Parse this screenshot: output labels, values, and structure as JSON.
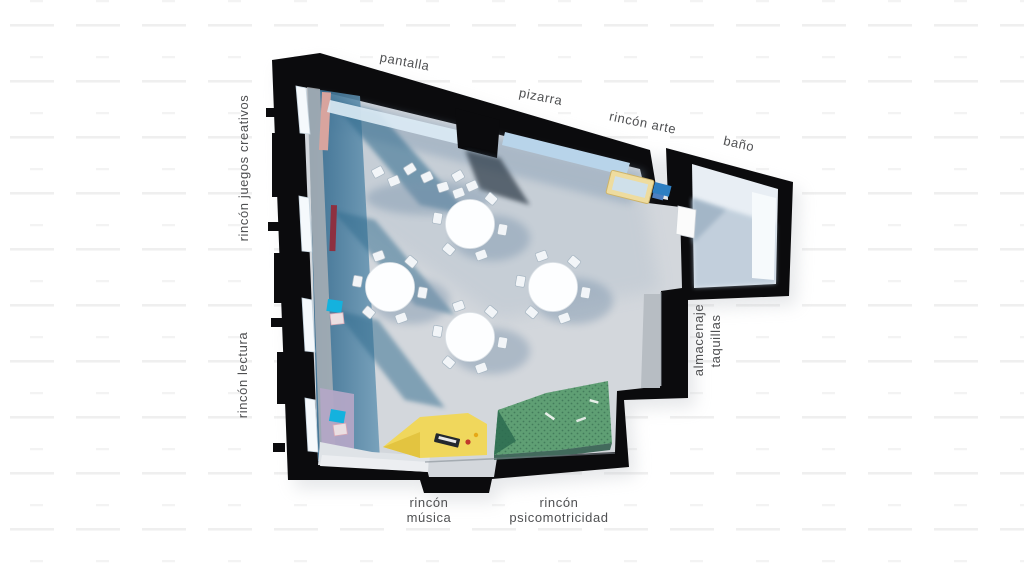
{
  "scene_type": "top-down 3D floor plan render of a classroom",
  "labels": {
    "pantalla": "pantalla",
    "pizarra": "pizarra",
    "rincon_arte": "rincón arte",
    "bano": "baño",
    "rincon_juegos_creativos": "rincón juegos creativos",
    "rincon_lectura": "rincón lectura",
    "almacenaje": {
      "line1": "almacenaje",
      "line2": "taquillas"
    },
    "rincon_musica": {
      "line1": "rincón",
      "line2": "música"
    },
    "rincon_psicomotricidad": {
      "line1": "rincón",
      "line2": "psicomotricidad"
    }
  },
  "zones": [
    {
      "label": "pantalla",
      "position": "top wall left"
    },
    {
      "label": "pizarra",
      "position": "top wall center"
    },
    {
      "label": "rincón arte",
      "position": "top wall right",
      "color": "#eedc9f"
    },
    {
      "label": "baño",
      "position": "annex room top right",
      "color": "#e8eef4"
    },
    {
      "label": "rincón juegos creativos",
      "position": "left wall upper",
      "color": "#35708f"
    },
    {
      "label": "rincón lectura",
      "position": "left wall lower",
      "color": "#b3a7c6"
    },
    {
      "label": "almacenaje taquillas",
      "position": "right wall",
      "color": "#b7bdc3"
    },
    {
      "label": "rincón música",
      "position": "bottom left",
      "color": "#f0d75c"
    },
    {
      "label": "rincón psicomotricidad",
      "position": "bottom center",
      "color": "#5f9f74"
    }
  ],
  "furniture": {
    "round_tables": 4,
    "chairs_per_table": 6,
    "loose_chairs_by_screen": 7
  },
  "palette": {
    "background": "#ffffff",
    "background_dashes": "#efefef",
    "walls": "#0b0b0d",
    "floor": "#d3d7dc",
    "floor_shadow_blue": "#7d95ad",
    "teal_play_zone": "#35708f",
    "music_rug_yellow": "#f0d75c",
    "psychomotor_rug_green": "#5f9f74",
    "reading_zone_lavender": "#b3a7c6",
    "art_table_yellow": "#eedc9f",
    "cushion_cyan": "#14b2de",
    "shelf_red": "#8e3040",
    "shelf_pink": "#d8a49e",
    "windows": "#f5f9fc",
    "bathroom_floor": "#e8eef4",
    "label_text": "#4f5052"
  }
}
